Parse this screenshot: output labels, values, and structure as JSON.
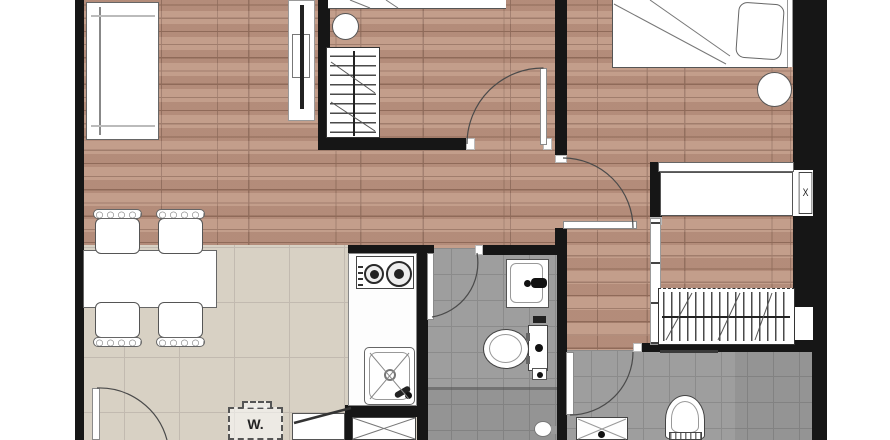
{
  "labels": {
    "washing_machine": "W.",
    "ac_unit": "X"
  },
  "rooms": [
    {
      "id": "living-dining",
      "floor": "wood"
    },
    {
      "id": "bedroom-1",
      "floor": "wood"
    },
    {
      "id": "bedroom-2",
      "floor": "wood"
    },
    {
      "id": "corridor",
      "floor": "wood"
    },
    {
      "id": "kitchen",
      "floor": "beige-tile"
    },
    {
      "id": "bathroom-1",
      "floor": "gray-tile"
    },
    {
      "id": "bathroom-2",
      "floor": "gray-tile"
    },
    {
      "id": "ac-ledge",
      "floor": "none"
    }
  ],
  "colors": {
    "wall": "#161616",
    "wood_floor": "#bd9480",
    "wood_line": "#97705e",
    "kitchen_tile": "#d8d1c4",
    "bath_tile": "#9e9e9e",
    "fixture_outline": "#555555",
    "background": "#ffffff"
  }
}
